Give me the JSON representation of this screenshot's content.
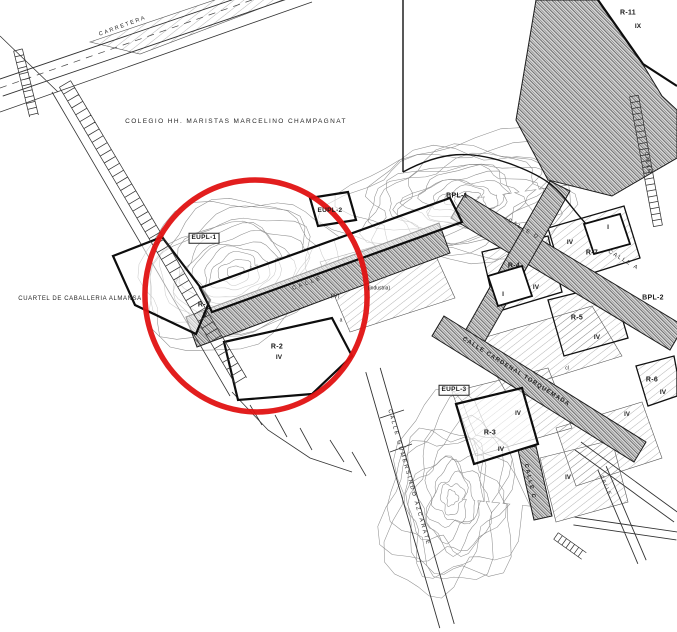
{
  "sites": {
    "colegio": "COLEGIO HH. MARISTAS MARCELINO CHAMPAGNAT",
    "cuartel": "CUARTEL DE CABALLERIA ALMANSA"
  },
  "streets": {
    "carretera": "CARRETERA",
    "calle_interior": "CALLE",
    "calle_d": "CALLE D",
    "calle_a": "CALLE A",
    "torquemada": "CALLE CARDENAL TORQUEMADA",
    "gumersindo": "CALLE GUMERSINDO AZCARATE",
    "calle_c": "CALLE C",
    "calle_se": "CALLE",
    "calle_ne": "CALLE"
  },
  "parcels": {
    "r11": {
      "code": "R-11",
      "floors": "IX"
    },
    "bpl1": {
      "code": "BPL-1"
    },
    "eupl2": {
      "code": "EUPL-2"
    },
    "eupl1": {
      "code": "EUPL-1"
    },
    "r1": {
      "code": "R-1",
      "floors": "V"
    },
    "r2": {
      "code": "R-2",
      "floors": "IV"
    },
    "r4": {
      "code": "R-4",
      "floors": "IV",
      "inner": "I"
    },
    "r7": {
      "code": "R-7",
      "floors": "IV",
      "inner": "I"
    },
    "r5": {
      "code": "R-5",
      "floors": "IV"
    },
    "bpl2": {
      "code": "BPL-2"
    },
    "r6": {
      "code": "R-6",
      "floors": "IV"
    },
    "eupl3": {
      "code": "EUPL-3"
    },
    "r3": {
      "code": "R-3",
      "floors": "IV"
    }
  },
  "zones": {
    "iv_a": "IV",
    "iv_b": "IV",
    "iv_c": "IV",
    "iv_paren": "(IV)",
    "industria": "(industria)"
  },
  "misc": {
    "a": "a",
    "cl": "cl"
  },
  "annotation": {
    "highlight_color": "#e01212"
  }
}
